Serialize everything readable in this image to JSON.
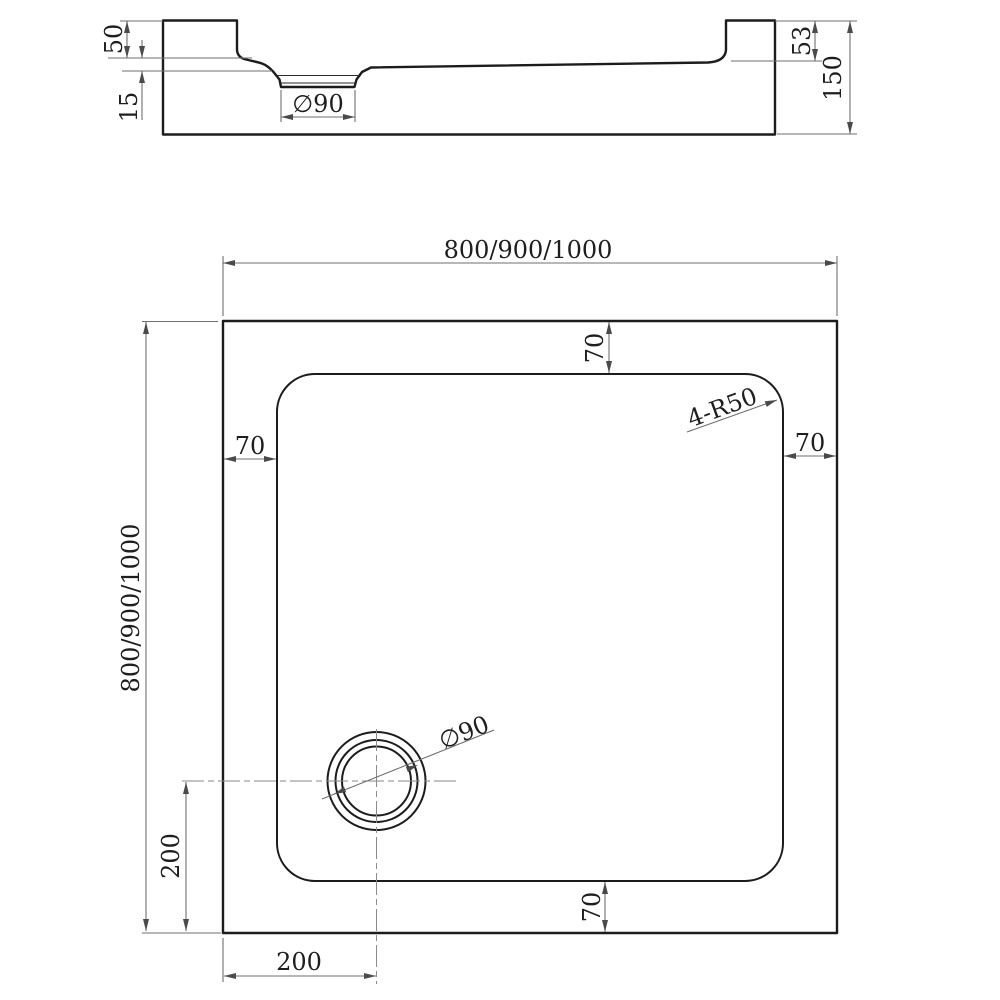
{
  "colors": {
    "background": "#ffffff",
    "outline": "#1c1c1c",
    "dimension_lines": "#6f6f6f",
    "text": "#1e1e1e"
  },
  "section_view": {
    "labels": {
      "rim_height": "50",
      "floor_recess_depth": "15",
      "drain_diameter": "∅90",
      "back_rim_height": "53",
      "overall_height": "150"
    }
  },
  "plan_view": {
    "labels": {
      "overall_width": "800/900/1000",
      "overall_depth": "800/900/1000",
      "top_border": "70",
      "left_border": "70",
      "right_border": "70",
      "bottom_border": "70",
      "corner_radius": "4-R50",
      "drain_diameter": "∅90",
      "drain_center_from_bottom": "200",
      "drain_center_from_left": "200"
    }
  }
}
